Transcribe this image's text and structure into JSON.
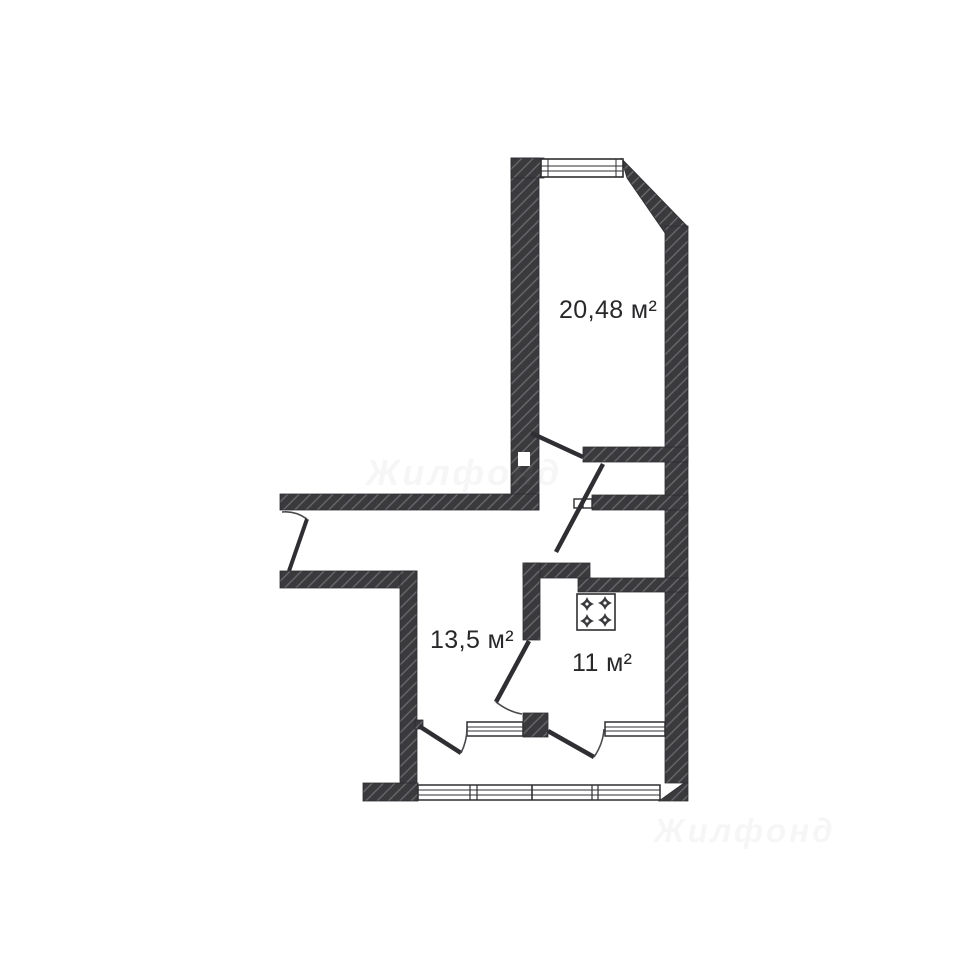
{
  "plan": {
    "type": "apartment floor plan",
    "rooms": [
      {
        "name": "living-room",
        "area_label": "20,48 м²",
        "area_m2": 20.48
      },
      {
        "name": "room",
        "area_label": "13,5 м²",
        "area_m2": 13.5
      },
      {
        "name": "kitchen",
        "area_label": "11 м²",
        "area_m2": 11
      }
    ],
    "icons": [
      {
        "name": "stove-icon",
        "meaning": "4-burner kitchen stove"
      }
    ],
    "features": [
      "entrance-door",
      "interior-doors",
      "windows",
      "balcony-glazing",
      "hatched-walls"
    ],
    "watermarks": {
      "center": "Жилфонд",
      "bottom_right": "Жилфонд"
    },
    "colors": {
      "wall_fill": "#3a3a3d",
      "hatch_line": "#6a6a70",
      "door_line": "#2f2f33",
      "outline": "#2e2e32",
      "background": "#ffffff",
      "label_text": "#28282b"
    }
  }
}
